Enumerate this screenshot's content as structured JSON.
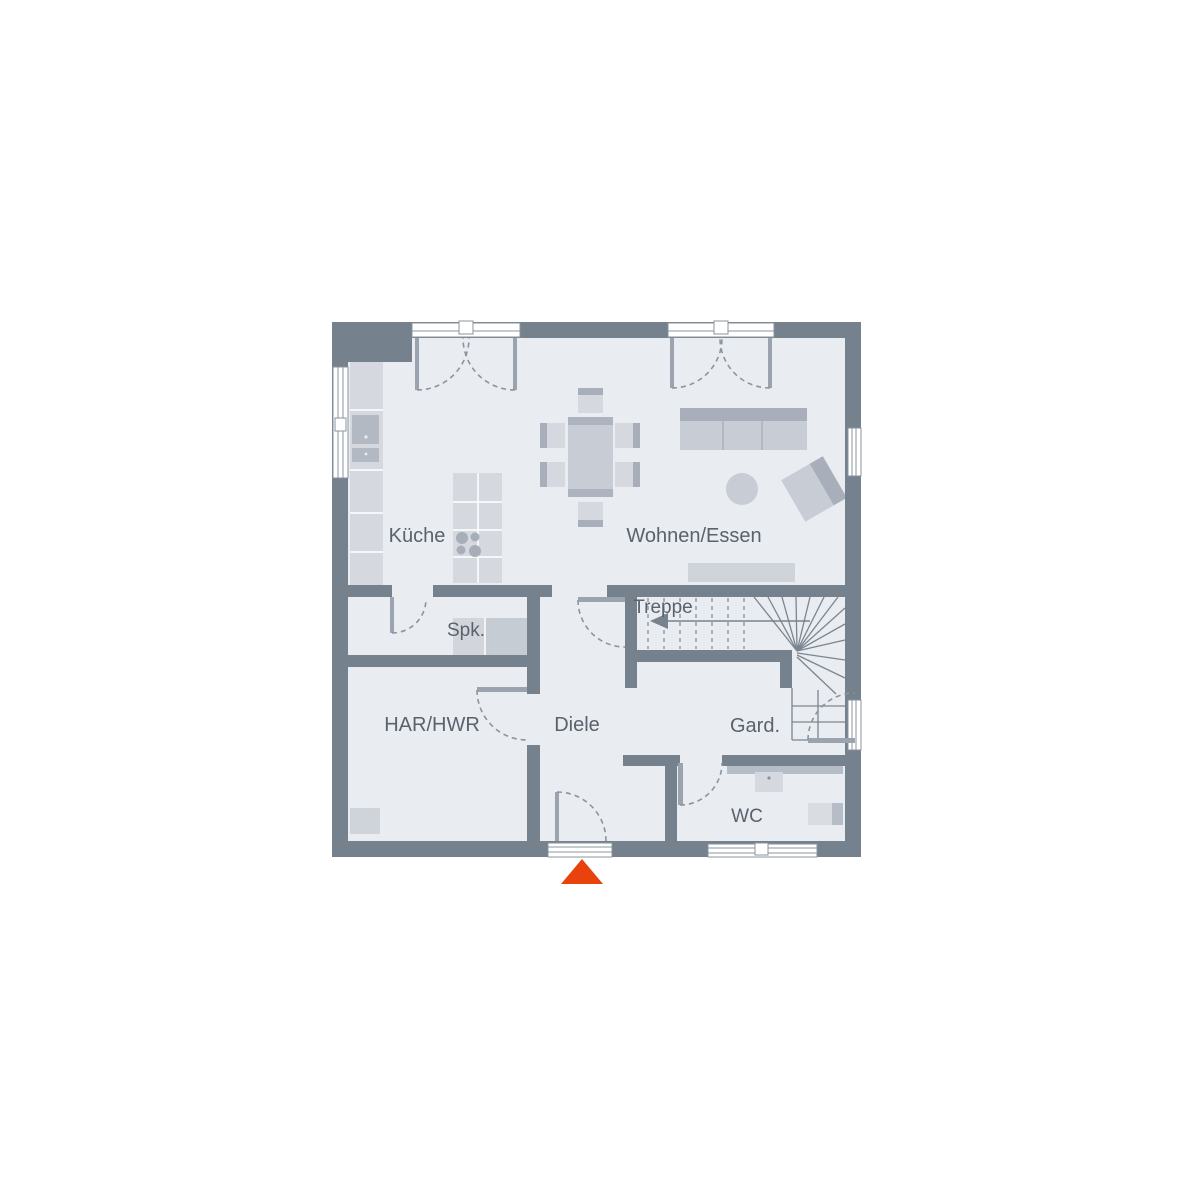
{
  "floorplan": {
    "title": "ground-floor-plan",
    "rooms": {
      "kueche": "Küche",
      "wohnen_essen": "Wohnen/Essen",
      "spk": "Spk.",
      "treppe": "Treppe",
      "har_hwr": "HAR/HWR",
      "diele": "Diele",
      "gard": "Gard.",
      "wc": "WC"
    },
    "colors": {
      "wall": "#76818e",
      "floor": "#e9ecf0",
      "furniture_light": "#d5d9df",
      "furniture_medium": "#c8cdd5",
      "furniture_dark": "#a8afba",
      "appliance": "#b2b9c3",
      "door_leaf": "#9aa3ae",
      "swing_arc": "#8b949f",
      "label_text": "#59626d",
      "entrance_marker": "#e8420d",
      "background": "#ffffff"
    },
    "markers": {
      "entrance_arrow": "entrance direction triangle"
    }
  }
}
